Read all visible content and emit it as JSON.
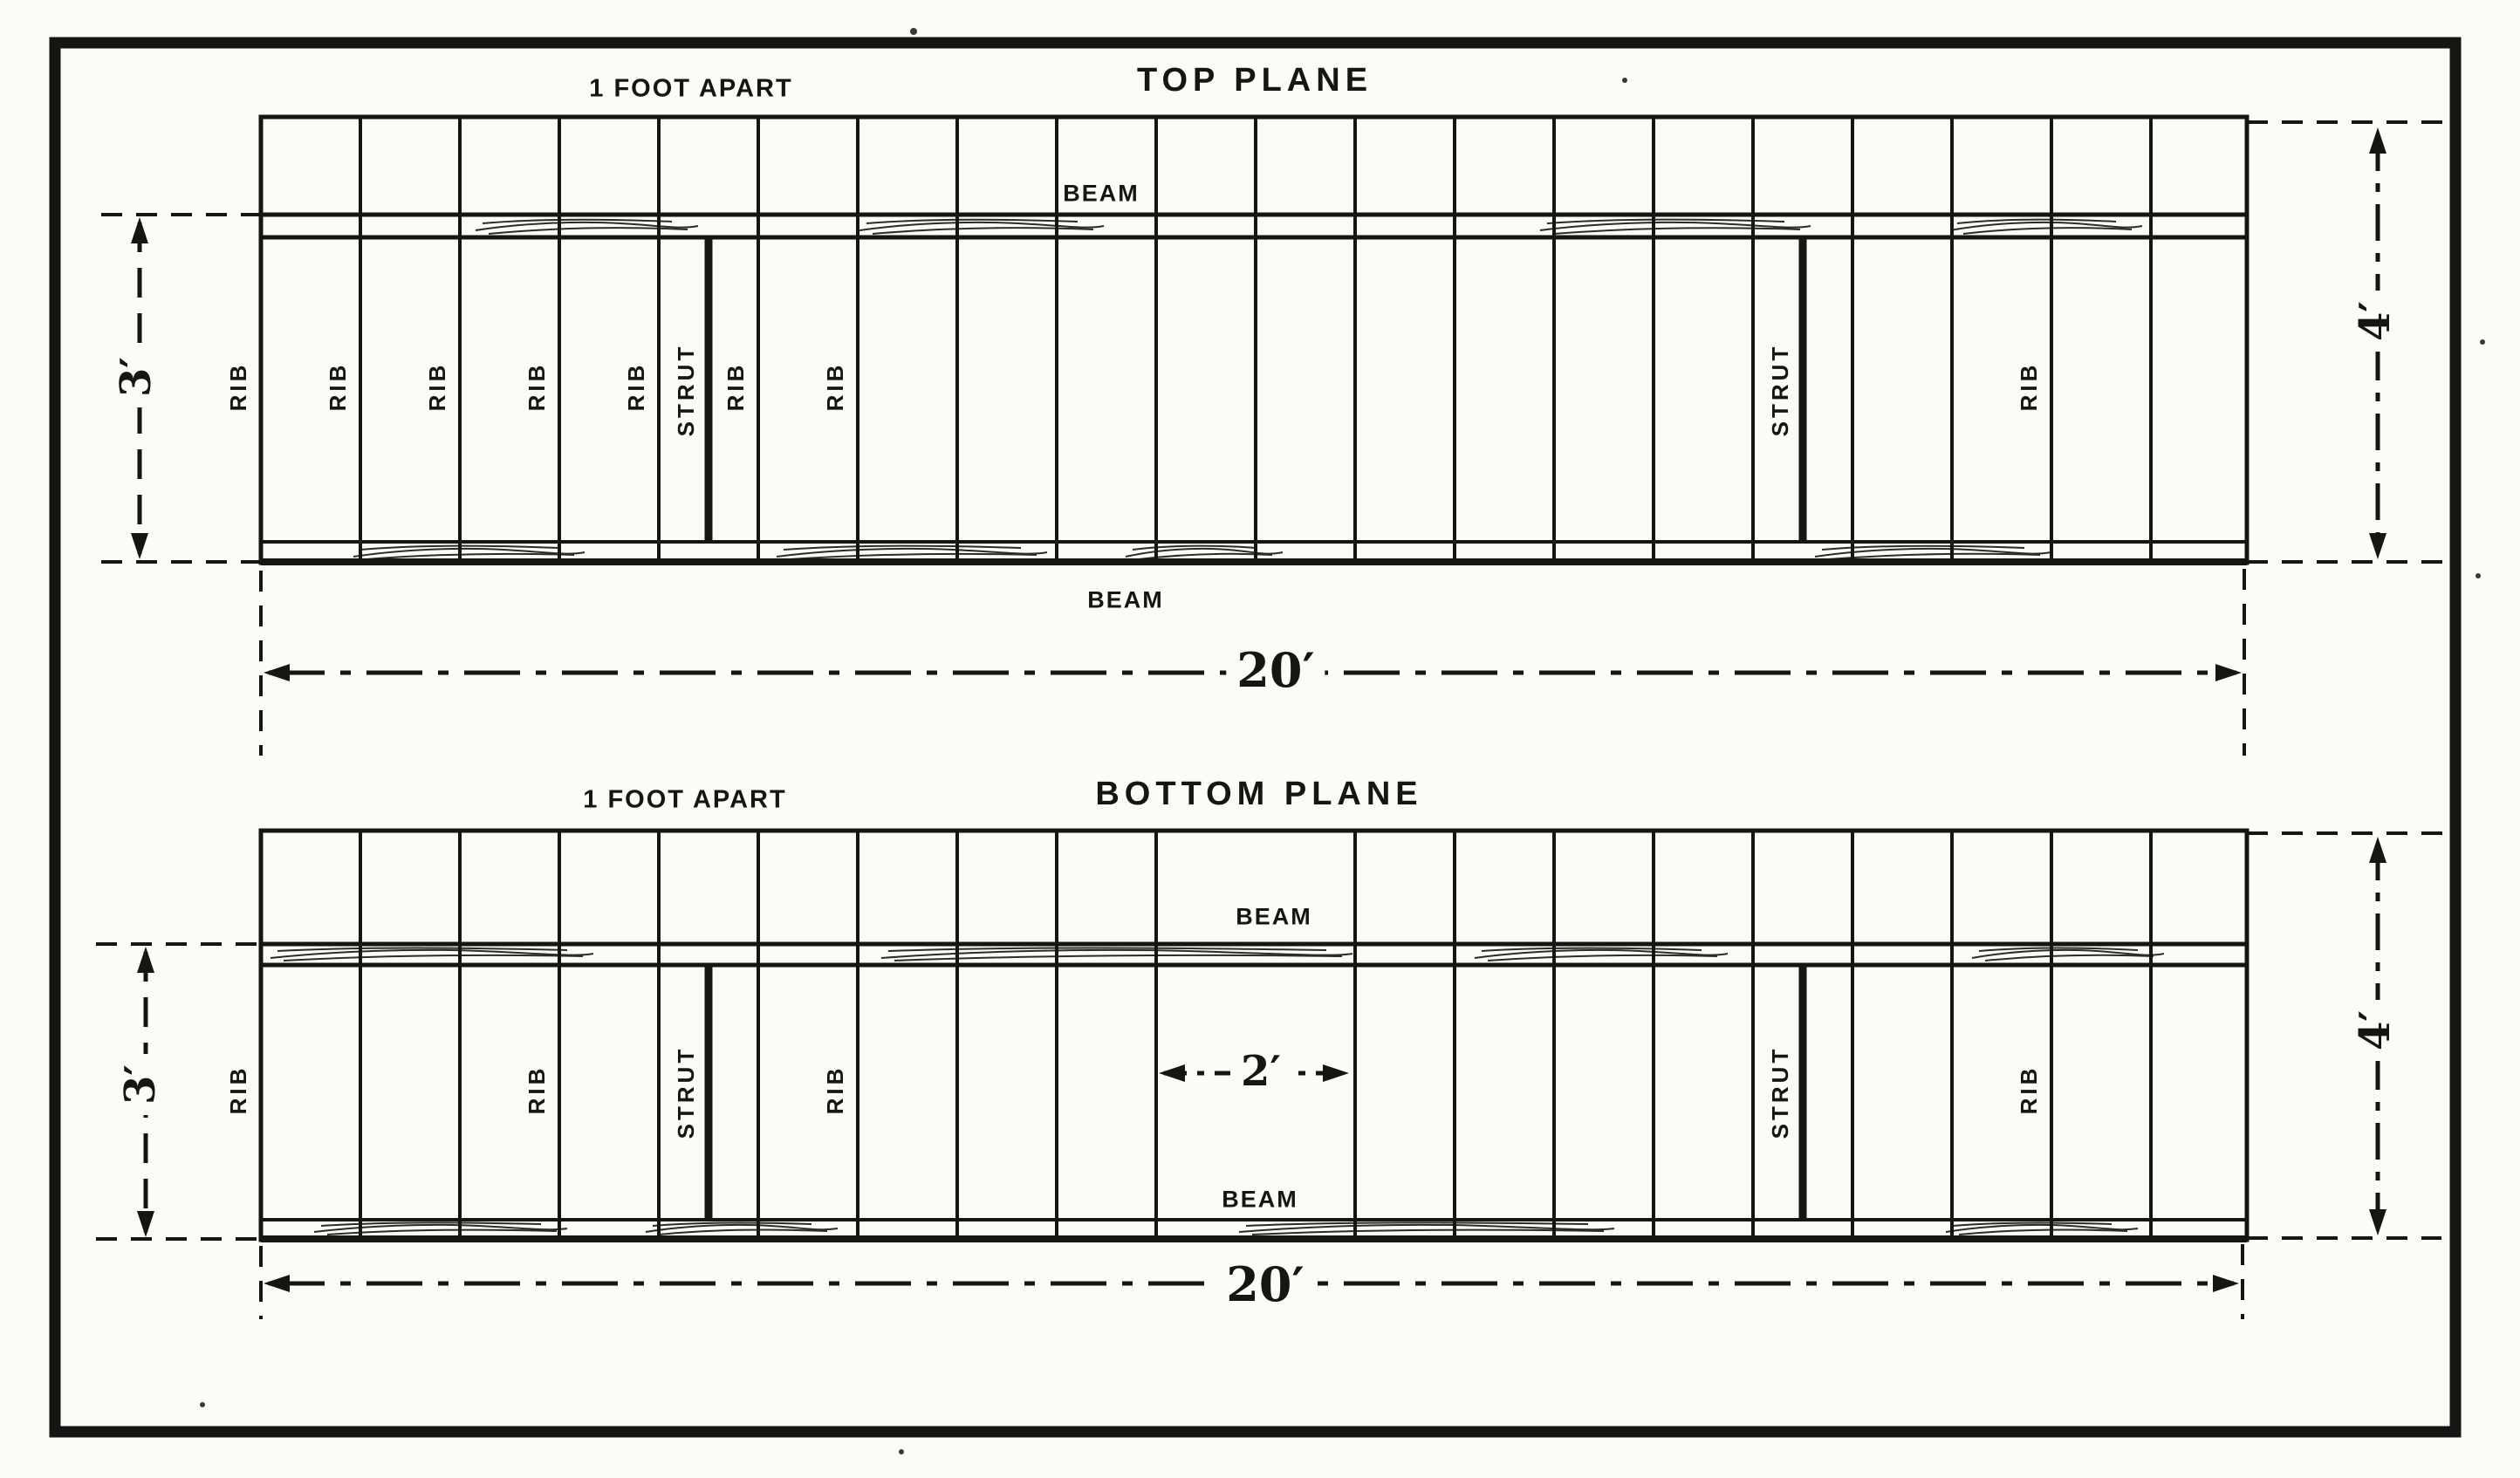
{
  "top_plane": {
    "title": "TOP PLANE",
    "spacing_note": "1 FOOT APART",
    "upper_beam_label": "BEAM",
    "lower_beam_label": "BEAM",
    "rib_labels": [
      "RIB",
      "RIB",
      "RIB",
      "RIB",
      "RIB",
      "RIB",
      "RIB",
      "RIB"
    ],
    "strut_labels": [
      "STRUT",
      "STRUT"
    ],
    "dims": {
      "beam_gap": "3′",
      "chord": "4′",
      "span": "20′"
    }
  },
  "bottom_plane": {
    "title": "BOTTOM PLANE",
    "spacing_note": "1 FOOT APART",
    "upper_beam_label": "BEAM",
    "lower_beam_label": "BEAM",
    "rib_labels": [
      "RIB",
      "RIB",
      "RIB",
      "RIB"
    ],
    "strut_labels": [
      "STRUT",
      "STRUT"
    ],
    "dims": {
      "beam_gap": "3′",
      "chord": "4′",
      "span": "20′",
      "rib_gap_center": "2′"
    }
  }
}
